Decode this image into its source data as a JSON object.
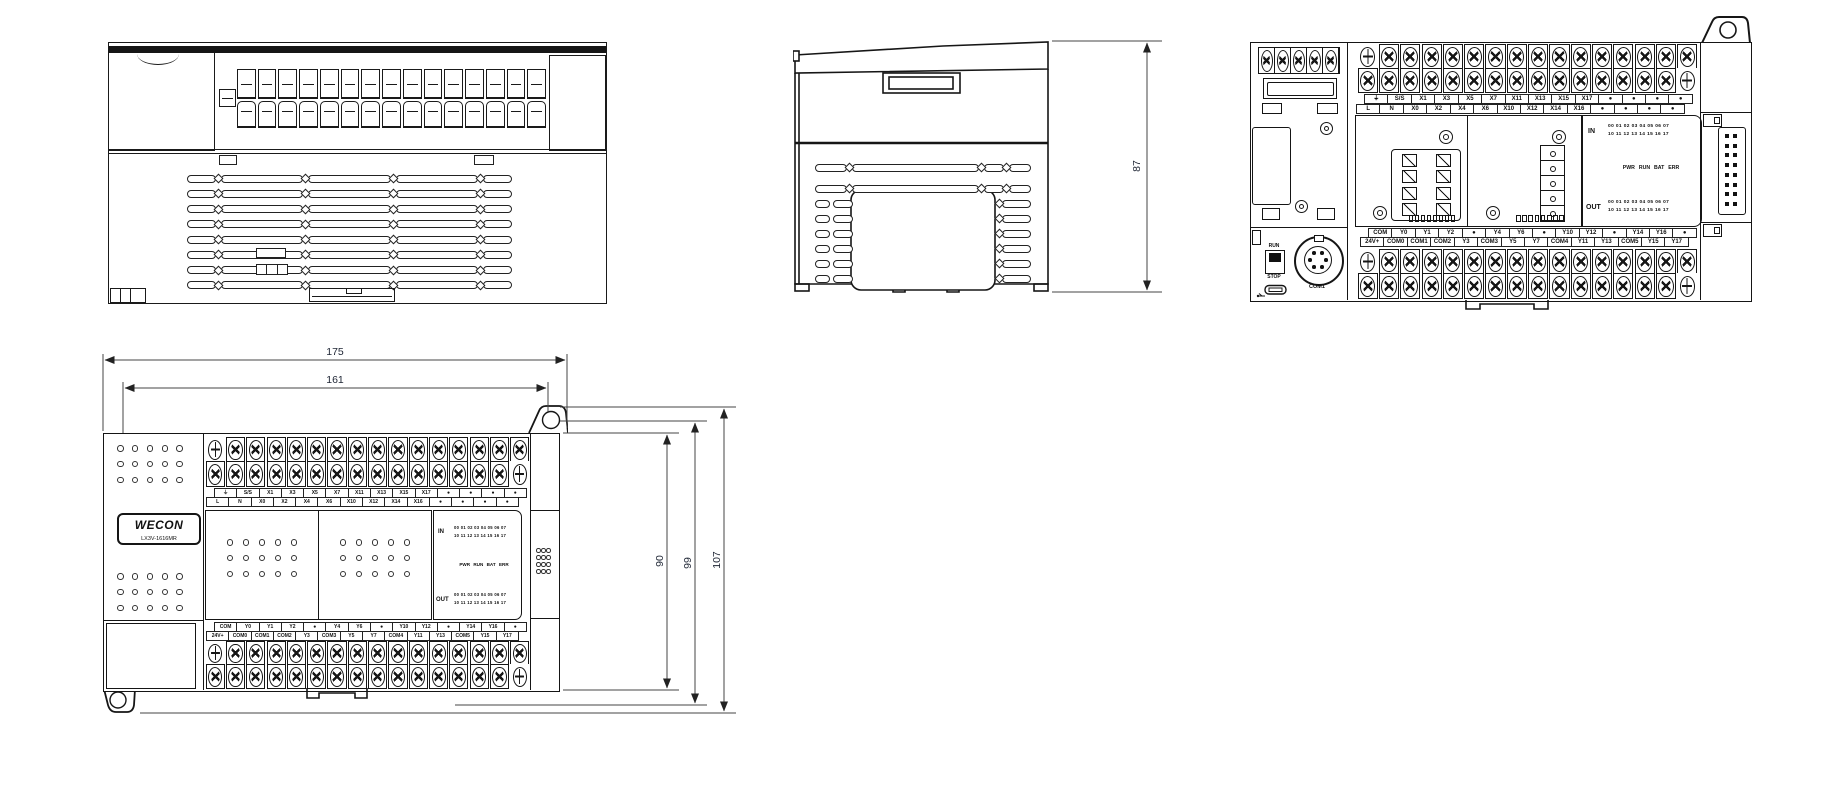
{
  "drawing": {
    "dims": {
      "side_height": "87",
      "width_total": "175",
      "width_mount": "161",
      "height_body": "90",
      "height_mount": "99",
      "height_total": "107"
    },
    "plc": {
      "brand": "WECON",
      "model": "LX3V-1616MR",
      "io_panel": {
        "in": "IN",
        "out": "OUT",
        "row_a": "00 01 02 03 04 05 06 07",
        "row_b": "10 11 12 13 14 15 16 17",
        "status": "PWR RUN BAT ERR"
      },
      "controls": {
        "run": "RUN",
        "stop": "STOP",
        "com_port": "COM1"
      },
      "terminals": {
        "top_upper": [
          "⏚",
          "S/S",
          "X1",
          "X3",
          "X5",
          "X7",
          "X11",
          "X13",
          "X15",
          "X17",
          "●",
          "●",
          "●",
          "●"
        ],
        "top_lower": [
          "L",
          "N",
          "X0",
          "X2",
          "X4",
          "X6",
          "X10",
          "X12",
          "X14",
          "X16",
          "●",
          "●",
          "●",
          "●"
        ],
        "bottom_upper": [
          "COM",
          "Y0",
          "Y1",
          "Y2",
          "●",
          "Y4",
          "Y6",
          "●",
          "Y10",
          "Y12",
          "●",
          "Y14",
          "Y16",
          "●"
        ],
        "bottom_lower": [
          "24V+",
          "COM0",
          "COM1",
          "COM2",
          "Y3",
          "COM3",
          "Y5",
          "Y7",
          "COM4",
          "Y11",
          "Y13",
          "COM5",
          "Y15",
          "Y17"
        ]
      }
    }
  }
}
